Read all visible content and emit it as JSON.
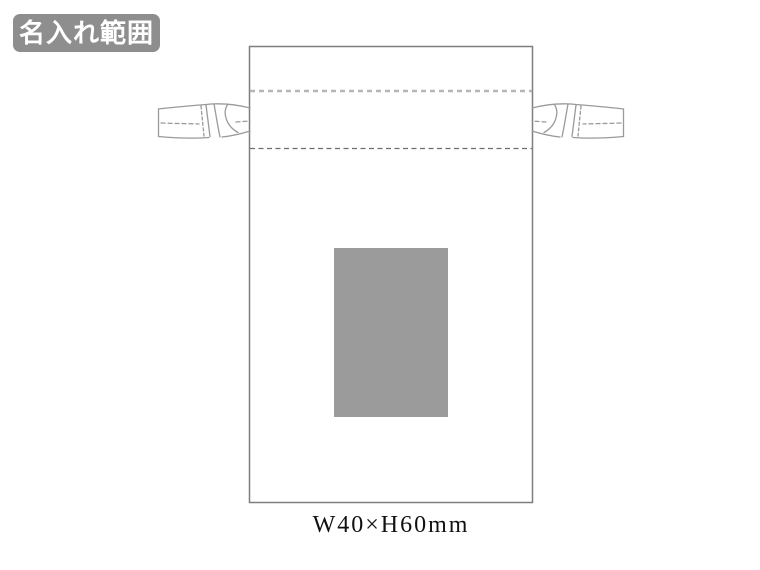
{
  "badge": {
    "label": "名入れ範囲",
    "bg_color": "#8e8e8e",
    "text_color": "#ffffff"
  },
  "diagram": {
    "bag_outline_color": "#7f7f7f",
    "bag_fill_color": "#ffffff",
    "channel_top_line_color": "#b6b6b6",
    "channel_bottom_line_color": "#6e6e6e",
    "cord_line_color": "#9a9a9a",
    "print_area_fill_color": "#9b9b9b"
  },
  "caption": {
    "size_label": "W40×H60mm"
  }
}
